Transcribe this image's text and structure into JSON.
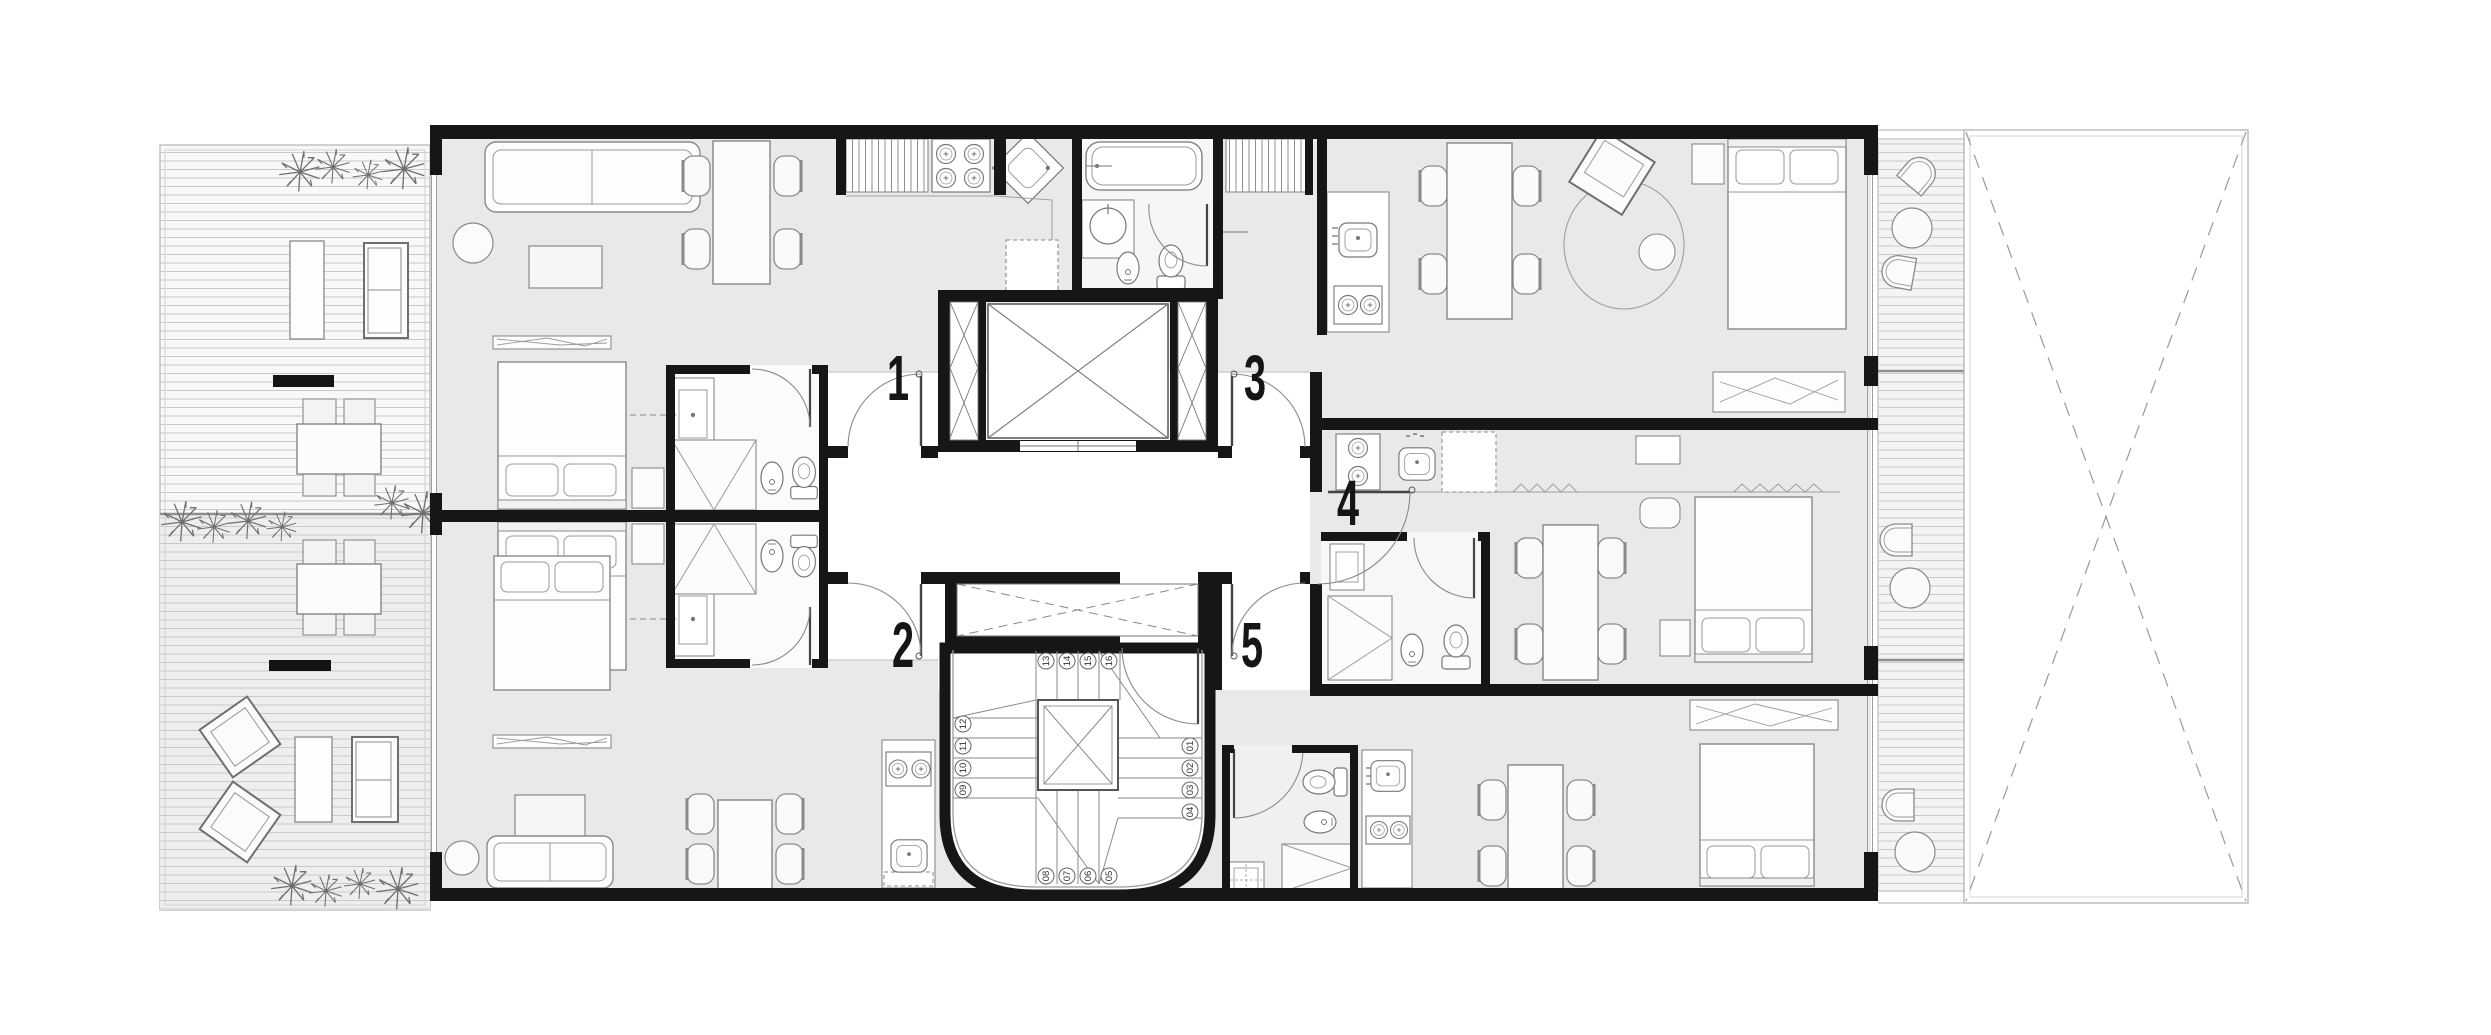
{
  "page": {
    "title": "Residential typical floor plan with five apartments"
  },
  "plan": {
    "units": [
      {
        "id": "unit-1",
        "label": "1"
      },
      {
        "id": "unit-2",
        "label": "2"
      },
      {
        "id": "unit-3",
        "label": "3"
      },
      {
        "id": "unit-4",
        "label": "4"
      },
      {
        "id": "unit-5",
        "label": "5"
      }
    ],
    "stair": {
      "steps": [
        "01",
        "02",
        "03",
        "04",
        "05",
        "06",
        "07",
        "08",
        "09",
        "10",
        "11",
        "12",
        "13",
        "14",
        "15",
        "16"
      ]
    },
    "colors": {
      "wall": "#161616",
      "apartment_floor": "#e9e9e9",
      "hall_floor": "#ffffff",
      "bathroom_floor": "#f7f7f7",
      "terrace_floor": "#f7f7f7",
      "deck_line": "#c9c9c9",
      "furniture_line": "#8a8a8a",
      "fixture_line": "#777777",
      "dashed_line": "#9a9a9a",
      "background": "#ffffff"
    },
    "symbols": [
      "elevator-shaft",
      "service-shaft",
      "winder-stair",
      "bathtub",
      "shower",
      "toilet",
      "bidet",
      "washbasin",
      "kitchen-sink",
      "stove-burners",
      "refrigerator-dashed",
      "double-bed",
      "sofa",
      "dining-table",
      "chair",
      "lounge-chair",
      "coffee-table",
      "tv-board",
      "plant",
      "deck-terrace",
      "open-void"
    ]
  }
}
